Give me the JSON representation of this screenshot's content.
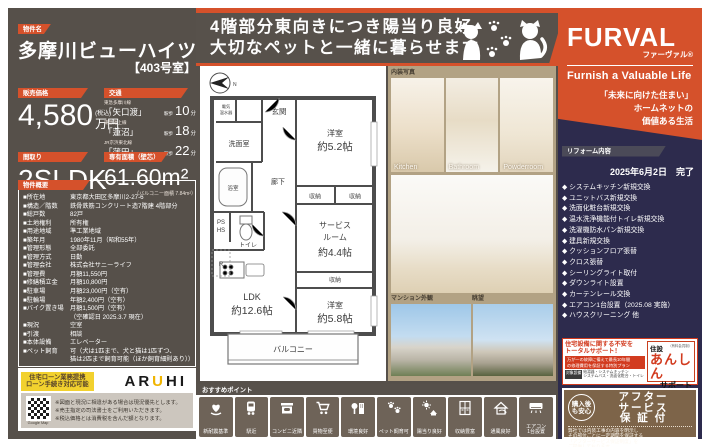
{
  "colors": {
    "orange": "#d5512b",
    "dark_brown": "#56504a",
    "navy": "#2d2b4d",
    "tan": "#b2a284",
    "yellow": "#f2d12e",
    "red": "#d23b1f"
  },
  "header": {
    "property_label": "物件名",
    "property_name": "多摩川ビューハイツ",
    "room_no": "【403号室】"
  },
  "banner": {
    "line1": "4階部分東向きにつき陽当り良好",
    "line2": "大切なペットと一緒に暮らせます"
  },
  "price": {
    "label": "販売価格",
    "amount": "4,580",
    "tax": "(税込)",
    "unit": "万円"
  },
  "access": {
    "label": "交通",
    "routes": [
      {
        "line": "東急多摩川線",
        "station": "「矢口渡」",
        "walk": "駅歩",
        "minutes": "10",
        "min_unit": "分"
      },
      {
        "line": "東急池上線",
        "station": "「蓮沼」",
        "walk": "駅歩",
        "minutes": "18",
        "min_unit": "分"
      },
      {
        "line": "JR京浜東北線",
        "station": "「蒲田」",
        "walk": "駅歩",
        "minutes": "22",
        "min_unit": "分"
      }
    ]
  },
  "layout": {
    "label": "間取り",
    "value": "2SLDK"
  },
  "area": {
    "label": "専有面積（壁芯）",
    "value": "61.60m²",
    "balcony_note": "（バルコニー面積 7.84m²）"
  },
  "overview": {
    "label": "物件概要",
    "rows": [
      {
        "k": "■所在地",
        "v": "東京都大田区多摩川2-27-6"
      },
      {
        "k": "■構造／階数",
        "v": "鉄骨鉄筋コンクリート造7階建 4階部分"
      },
      {
        "k": "■総戸数",
        "v": "82戸"
      },
      {
        "k": "■土地権利",
        "v": "所有権"
      },
      {
        "k": "■用途地域",
        "v": "準工業地域"
      },
      {
        "k": "■築年月",
        "v": "1980年11月（昭和55年）"
      },
      {
        "k": "■管理形態",
        "v": "全部委託"
      },
      {
        "k": "■管理方式",
        "v": "日勤"
      },
      {
        "k": "■管理会社",
        "v": "株式会社サニーライフ"
      },
      {
        "k": "■管理費",
        "v": "月額11,550円"
      },
      {
        "k": "■修繕積立金",
        "v": "月額10,800円"
      },
      {
        "k": "■駐車場",
        "v": "月額23,000円（空有）"
      },
      {
        "k": "■駐輪場",
        "v": "年額2,400円（空有）"
      },
      {
        "k": "■バイク置き場",
        "v": "月額1,500円（空有）"
      },
      {
        "k": "",
        "v": "（空確認日 2025.3.7 現在）"
      },
      {
        "k": "■現況",
        "v": "空室"
      },
      {
        "k": "■引渡",
        "v": "相談"
      },
      {
        "k": "■本体設備",
        "v": "エレベーター"
      },
      {
        "k": "■ペット飼育",
        "v": "可（犬は1匹まで、犬と猫は1匹ずつ、"
      },
      {
        "k": "",
        "v": "猫は2匹まで飼育可能（ほか飼育細則あり））"
      }
    ]
  },
  "loan": {
    "badge1": "住宅ローン業務提携",
    "badge2": "ローン手続き対応可能",
    "aruhi_pre": "AR",
    "aruhi_u": "U",
    "aruhi_post": "HI",
    "qr_caption": "Google Map",
    "notes": [
      "※図面と現況に相違がある場合は現況優先とします。",
      "※売主指定の司法書士をご利用いただきます。",
      "※税込価格とは消費税を含んだ額となります。"
    ]
  },
  "brand": {
    "logo": "FURVAL",
    "logo_kana": "ファーヴァル®",
    "tagline": "Furnish a Valuable Life",
    "slogan1": "「未来に向けた住まい」",
    "slogan2": "ホームネットの",
    "slogan3": "価値ある生活"
  },
  "reform": {
    "label": "リフォーム内容",
    "date": "2025年6月2日　完了",
    "items": [
      "◆ システムキッチン新規交換",
      "◆ ユニットバス新規交換",
      "◆ 洗面化粧台新規交換",
      "◆ 温水洗浄機能付トイレ新規交換",
      "◆ 洗濯機防水パン新規交換",
      "◆ 建具新規交換",
      "◆ クッションフロア張替",
      "◆ クロス張替",
      "◆ シーリングライト取付",
      "◆ ダウンライト設置",
      "◆ カーテンレール交換",
      "◆ エアコン1台設置（2025.08 実施）",
      "◆ ハウスクリーニング 他"
    ]
  },
  "anshin": {
    "title1": "住宅設備に関する不安を",
    "title2": "トータルサポート！",
    "sub1": "万が一の故障に備えて最長10年間",
    "sub2": "の修理費用を保証する特別プラン",
    "scope_tag": "対象設備",
    "scope1": "給湯器・システムキッチン",
    "scope2": "システムバス・洗面化粧台・トイレ",
    "logo_top": "住設",
    "logo_note": "（有料会員制）",
    "logo_main": "あんしん",
    "logo_bottom": "サポート"
  },
  "after": {
    "circle1": "購入後",
    "circle2": "も安心",
    "title1": "アフター",
    "title2": "サービス",
    "title3": "保 証 付",
    "body1": "弊社では内装工事の内容を明示し",
    "body2": "その部位ごとに一定期間を保証する",
    "body3": "「アフターサービス保証制度」を",
    "body4": "ご提供しております。"
  },
  "points": {
    "label": "おすすめポイント",
    "items": [
      {
        "label": "新耐震基準",
        "icon": "quake-standard-icon"
      },
      {
        "label": "駅近",
        "icon": "train-icon"
      },
      {
        "label": "コンビニ近隣",
        "icon": "convenience-store-icon"
      },
      {
        "label": "買物至便",
        "icon": "shopping-cart-icon"
      },
      {
        "label": "環境良好",
        "icon": "environment-icon"
      },
      {
        "label": "ペット飼育可",
        "icon": "paw-icon"
      },
      {
        "label": "陽当り良好",
        "icon": "sun-house-icon"
      },
      {
        "label": "収納豊富",
        "icon": "closet-icon"
      },
      {
        "label": "通風良好",
        "icon": "airflow-house-icon"
      },
      {
        "label": "エアコン\n1台設置",
        "icon": "air-conditioner-icon"
      }
    ]
  },
  "photos": {
    "interior_label": "内装写真",
    "captions": [
      "Kitchen",
      "Bathroom",
      "Powderroom"
    ],
    "exterior_label": "マンション外観",
    "view_label": "眺望"
  },
  "floorplan": {
    "labels": {
      "compass": "N",
      "entrance": "玄関",
      "room52_name": "洋室",
      "room52_size": "約5.2帖",
      "closet": "収納",
      "washroom": "洗面室",
      "bath": "浴室",
      "hallway": "廊下",
      "ps": "PS",
      "hs": "HS",
      "toilet": "トイレ",
      "fridge": "R",
      "heater1": "電気",
      "heater2": "温水器",
      "service1": "サービス",
      "service2": "ルーム",
      "service3": "約4.4帖",
      "ldk": "LDK",
      "ldk_size": "約12.6帖",
      "room58_name": "洋室",
      "room58_size": "約5.8帖",
      "balcony": "バルコニー"
    }
  }
}
